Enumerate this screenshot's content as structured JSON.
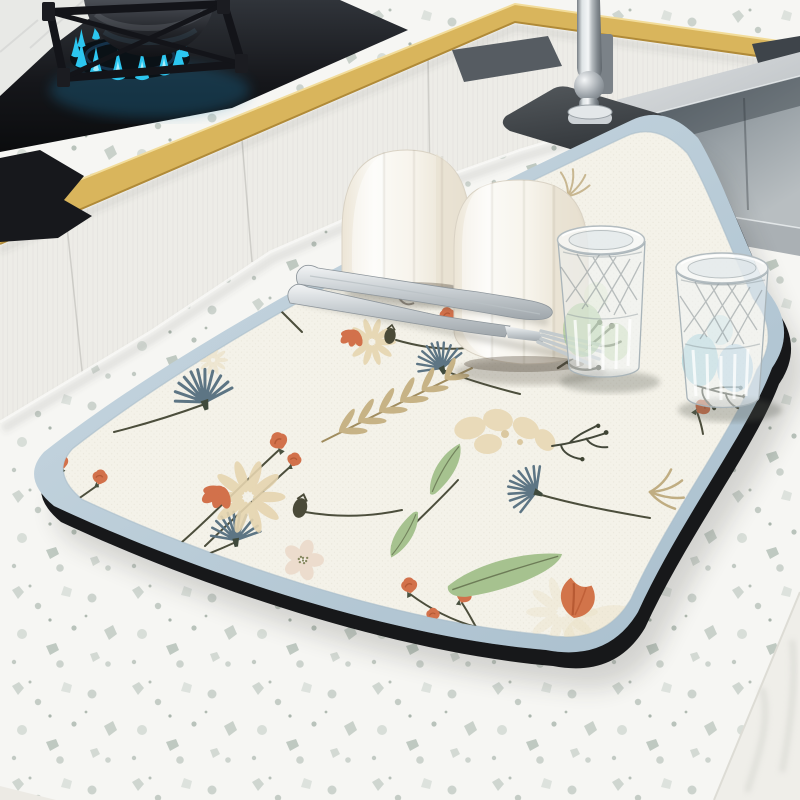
{
  "meta": {
    "domain": "product photograph",
    "setting": "modern white kitchen with terrazzo counters, gas cooktop and stainless sink",
    "subject": "floral absorbent dish-drying mat styled with upturned ceramic cups, cut-crystal glasses and cutlery"
  },
  "colors": {
    "terrazzo_base": "#f6f6f3",
    "speckle": "#c9d1ca",
    "wall_tile": "#e8e9e6",
    "cabinet": "#edece7",
    "gold_trim": "#d9b55c",
    "cooktop_black": "#141519",
    "flame": "#2cc6f0",
    "pot": "#24262b",
    "steel_light": "#d6dadc",
    "steel_dark": "#6e767c",
    "sink_basin": "#8d959b",
    "faucet_chrome": "#c9cfd3",
    "tray": "#565c62",
    "faucet_mat": "#43474b",
    "mat_border": "#b9cdd9",
    "mat_face": "#f4f2e9",
    "mat_underside": "#17181a",
    "ceramic_white": "#f8f6f0",
    "glass_tint_green": "#93c07f",
    "glass_tint_blue": "#7fc0cf",
    "floral_blue": "#5d7584",
    "floral_coral": "#d2714b",
    "floral_tan_petal": "#e6d5b0",
    "floral_green": "#a6c28f",
    "floral_stem": "#4c4e3c"
  },
  "objects": {
    "wall": {
      "label": "white tiled wall"
    },
    "back_counter": {
      "label": "terrazzo back counter with gold edge trim"
    },
    "cabinets": {
      "label": "white panelled cabinet fronts"
    },
    "cooktop": {
      "label": "black glass gas cooktop"
    },
    "grate": {
      "label": "cast-iron burner grate"
    },
    "flame": {
      "label": "ring of blue gas flames"
    },
    "pot": {
      "label": "dark pot heating over the burner"
    },
    "tray_left": {
      "label": "slate tray on back counter"
    },
    "tray_right": {
      "label": "slate tray at counter corner"
    },
    "island": {
      "label": "white terrazzo island worktop"
    },
    "sink": {
      "label": "undermount stainless-steel sink"
    },
    "faucet": {
      "label": "polished chrome faucet"
    },
    "faucet_mat": {
      "label": "charcoal stone faucet mat"
    },
    "mat": {
      "label": "powder-blue bordered drying mat with watercolor wildflower print",
      "motifs": "blue thistles, coral buds, beige daisies, tan ferns, green leaves, orange tulip, pale blossom",
      "border": "powder blue",
      "face": "warm ivory",
      "underside": "black rubber base"
    },
    "cup_left": {
      "label": "upturned white faceted ceramic cup"
    },
    "cup_right": {
      "label": "upturned white faceted ceramic cup"
    },
    "glass_left": {
      "label": "upturned cut-crystal glass with green reflections"
    },
    "glass_right": {
      "label": "upturned cut-crystal glass with blue reflections"
    },
    "knife": {
      "label": "stainless table knife"
    },
    "fork": {
      "label": "stainless dinner fork"
    }
  }
}
